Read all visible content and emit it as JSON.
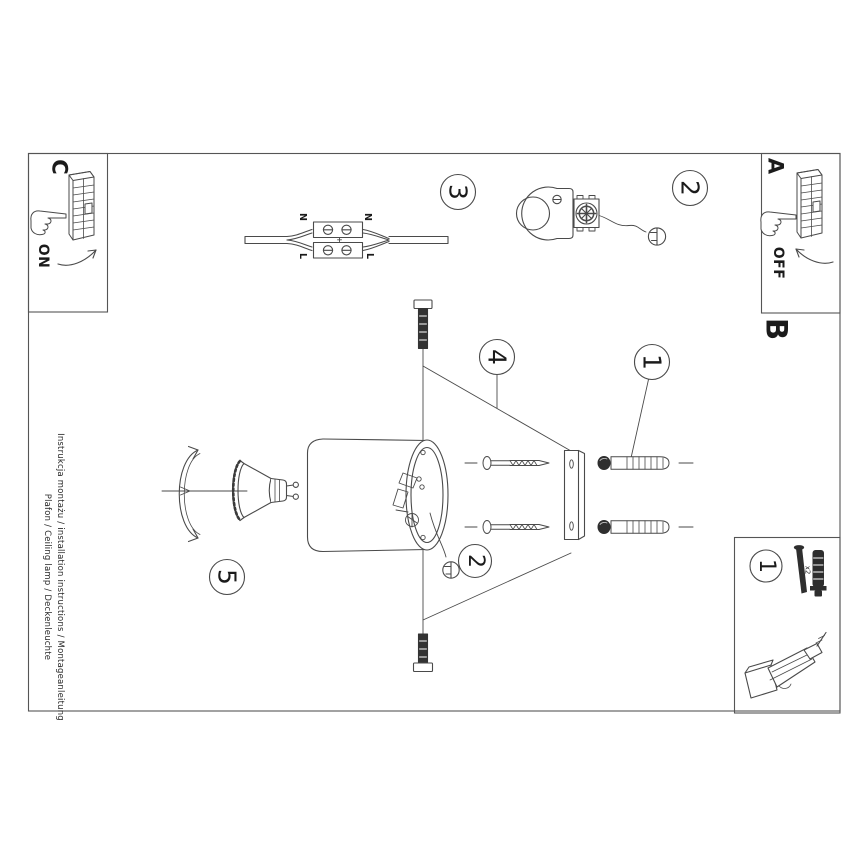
{
  "sheet": {
    "footer_line1": "Instrukcja montażu / installation instructions / Montageanleitung",
    "footer_line2": "Plafon / Ceiling lamp / Deckenleuchte"
  },
  "labels": {
    "box_a": "A",
    "box_b": "B",
    "box_c": "C",
    "switch_on": "ON",
    "switch_off": "OFF",
    "terminal_n_left": "N",
    "terminal_n_right": "N",
    "terminal_l_left": "L",
    "terminal_l_right": "L",
    "parts_qty": "x2"
  },
  "steps": {
    "step1": "1",
    "step2": "2",
    "step3": "3",
    "step4": "4",
    "step5": "5",
    "step2_assembly": "2",
    "parts_box_step": "1"
  },
  "icons": {
    "wall_switch": "wall-switch-icon",
    "pointing_hand": "pointing-hand-icon",
    "ground_screw": "ground-screw-icon",
    "drill": "drill-icon"
  },
  "colors": {
    "ink": "#4a4a4a",
    "paper": "#ffffff"
  }
}
